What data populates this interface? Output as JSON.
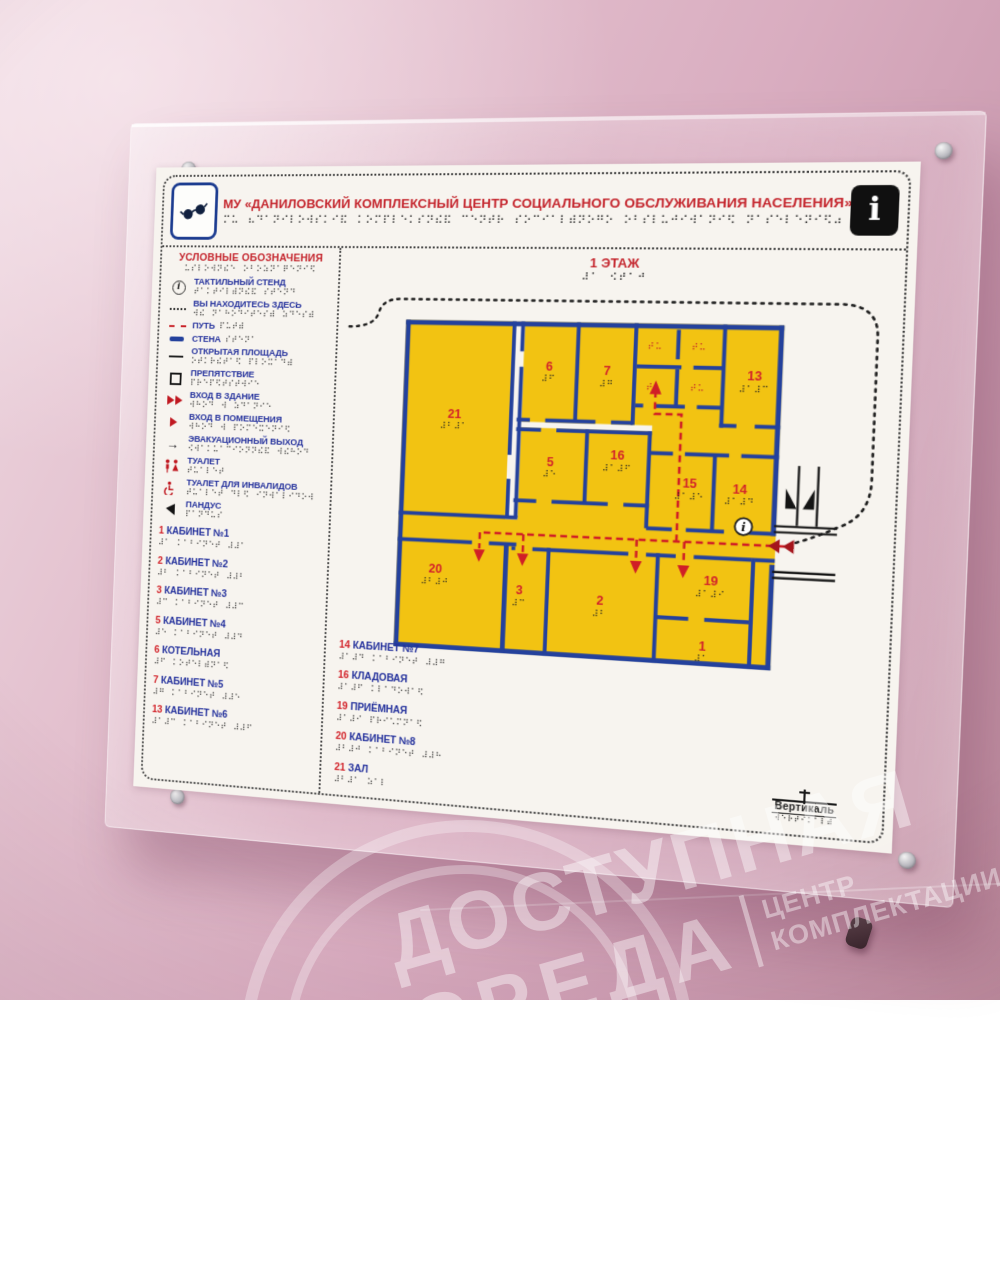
{
  "header": {
    "title": "МУ «ДАНИЛОВСКИЙ КОМПЛЕКСНЫЙ ЦЕНТР СОЦИАЛЬНОГО ОБСЛУЖИВАНИЯ НАСЕЛЕНИЯ»",
    "left_icon": "low-vision-glasses",
    "right_icon": "information"
  },
  "legend": {
    "title": "УСЛОВНЫЕ ОБОЗНАЧЕНИЯ",
    "items": [
      {
        "symbol": "tactile-stand",
        "label": "ТАКТИЛЬНЫЙ СТЕНД"
      },
      {
        "symbol": "you-are-here",
        "label": "ВЫ НАХОДИТЕСЬ ЗДЕСЬ"
      },
      {
        "symbol": "path",
        "label": "ПУТЬ"
      },
      {
        "symbol": "wall",
        "label": "СТЕНА"
      },
      {
        "symbol": "open-area",
        "label": "ОТКРЫТАЯ ПЛОЩАДЬ"
      },
      {
        "symbol": "obstacle",
        "label": "ПРЕПЯТСТВИЕ"
      },
      {
        "symbol": "building-entrance",
        "label": "ВХОД В ЗДАНИЕ"
      },
      {
        "symbol": "room-entrance",
        "label": "ВХОД В ПОМЕЩЕНИЯ"
      },
      {
        "symbol": "evacuation-exit",
        "label": "ЭВАКУАЦИОННЫЙ ВЫХОД"
      },
      {
        "symbol": "toilet",
        "label": "ТУАЛЕТ"
      },
      {
        "symbol": "accessible-toilet",
        "label": "ТУАЛЕТ ДЛЯ ИНВАЛИДОВ"
      },
      {
        "symbol": "ramp",
        "label": "ПАНДУС"
      }
    ],
    "rooms": [
      {
        "num": "1",
        "label": "КАБИНЕТ №1"
      },
      {
        "num": "2",
        "label": "КАБИНЕТ №2"
      },
      {
        "num": "3",
        "label": "КАБИНЕТ №3"
      },
      {
        "num": "5",
        "label": "КАБИНЕТ №4"
      },
      {
        "num": "6",
        "label": "КОТЕЛЬНАЯ"
      },
      {
        "num": "7",
        "label": "КАБИНЕТ №5"
      },
      {
        "num": "13",
        "label": "КАБИНЕТ №6"
      }
    ]
  },
  "map": {
    "floor_title": "1 ЭТАЖ",
    "rooms_list2": [
      {
        "num": "14",
        "label": "КАБИНЕТ №7"
      },
      {
        "num": "16",
        "label": "КЛАДОВАЯ"
      },
      {
        "num": "19",
        "label": "ПРИЁМНАЯ"
      },
      {
        "num": "20",
        "label": "КАБИНЕТ №8"
      },
      {
        "num": "21",
        "label": "ЗАЛ"
      }
    ],
    "room_labels": [
      {
        "num": "21",
        "x": 60,
        "y": 108
      },
      {
        "num": "6",
        "x": 158,
        "y": 56
      },
      {
        "num": "7",
        "x": 218,
        "y": 60
      },
      {
        "num": "13",
        "x": 366,
        "y": 62
      },
      {
        "num": "5",
        "x": 163,
        "y": 155
      },
      {
        "num": "16",
        "x": 232,
        "y": 146
      },
      {
        "num": "15",
        "x": 306,
        "y": 172
      },
      {
        "num": "14",
        "x": 356,
        "y": 176
      },
      {
        "num": "20",
        "x": 46,
        "y": 272
      },
      {
        "num": "3",
        "x": 136,
        "y": 290
      },
      {
        "num": "2",
        "x": 220,
        "y": 296
      },
      {
        "num": "19",
        "x": 331,
        "y": 270
      },
      {
        "num": "1",
        "x": 325,
        "y": 336
      }
    ],
    "toilet_marks": [
      {
        "t": "ТУ",
        "x": 266,
        "y": 32
      },
      {
        "t": "ТУ",
        "x": 310,
        "y": 32
      },
      {
        "t": "ТУ",
        "x": 266,
        "y": 74
      },
      {
        "t": "ТУ",
        "x": 310,
        "y": 74
      }
    ]
  },
  "footer": {
    "logo_text": "Вертикаль"
  },
  "watermark": {
    "line1": "ДОСТУПНАЯ",
    "line2": "СРЕДА",
    "right1": "ЦЕНТР",
    "right2": "КОМПЛЕКТАЦИИ"
  },
  "colors": {
    "accent_red": "#c4242c",
    "text_blue": "#23309c",
    "wall_blue": "#24419c",
    "room_yellow": "#f2c312",
    "path_red": "#d01f26",
    "wall_pink": "#d9adc0"
  }
}
